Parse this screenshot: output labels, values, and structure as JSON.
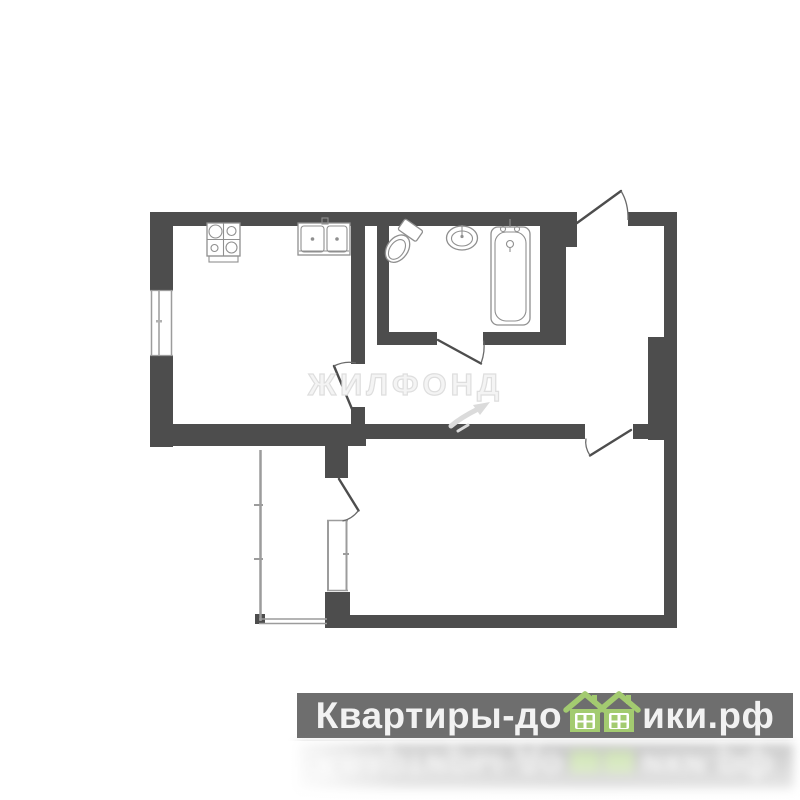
{
  "colors": {
    "wall": "#4d4d4d",
    "fixture_line": "#8f8f8f",
    "thin_line": "#9c9c9c",
    "door_line": "#4d4d4d",
    "watermark_fill": "#f4f4f4",
    "watermark_stroke": "#dedede",
    "banner_bg": "#6e6e6e",
    "banner_text": "#f2f2f2",
    "house_green": "#a3cb70"
  },
  "floorplan": {
    "watermark_text": "ЖИЛФОНД",
    "icons": [
      "stove-icon",
      "kitchen-sink-icon",
      "toilet-icon",
      "washbasin-icon",
      "bathtub-icon",
      "watermark-arrow-icon"
    ]
  },
  "logo": {
    "text_before_houses": "Квартиры-до",
    "text_after_houses": "ики.рф",
    "full_brand": "Квартиры-домики.рф",
    "icon": "houses-icon"
  }
}
